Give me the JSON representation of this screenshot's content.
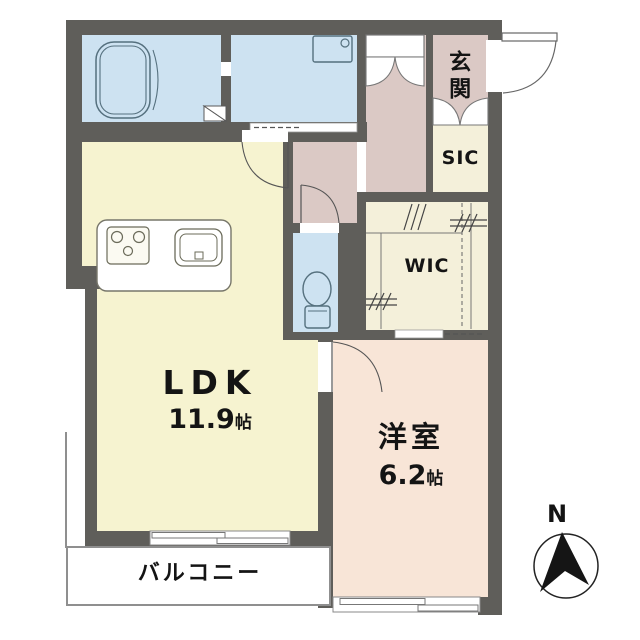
{
  "rooms": {
    "ldk": {
      "label": "LDK",
      "area_value": "11.9",
      "area_unit": "帖"
    },
    "western": {
      "label": "洋室",
      "area_value": "6.2",
      "area_unit": "帖"
    },
    "entrance": {
      "label": "玄関"
    },
    "shoe_closet": {
      "label": "SIC"
    },
    "walk_in_closet": {
      "label": "WIC"
    },
    "balcony": {
      "label": "バルコニー"
    }
  },
  "compass": {
    "north": "N"
  },
  "colors": {
    "wall": "#5f5e5a",
    "wet_area_floor": "#cde2f1",
    "ldk_floor": "#f6f3d0",
    "hallway_floor": "#dbc9c5",
    "bedroom_floor": "#f8e5d7",
    "closet_floor": "#f4f0da",
    "outline": "#8f8f8f",
    "text": "#141414"
  }
}
